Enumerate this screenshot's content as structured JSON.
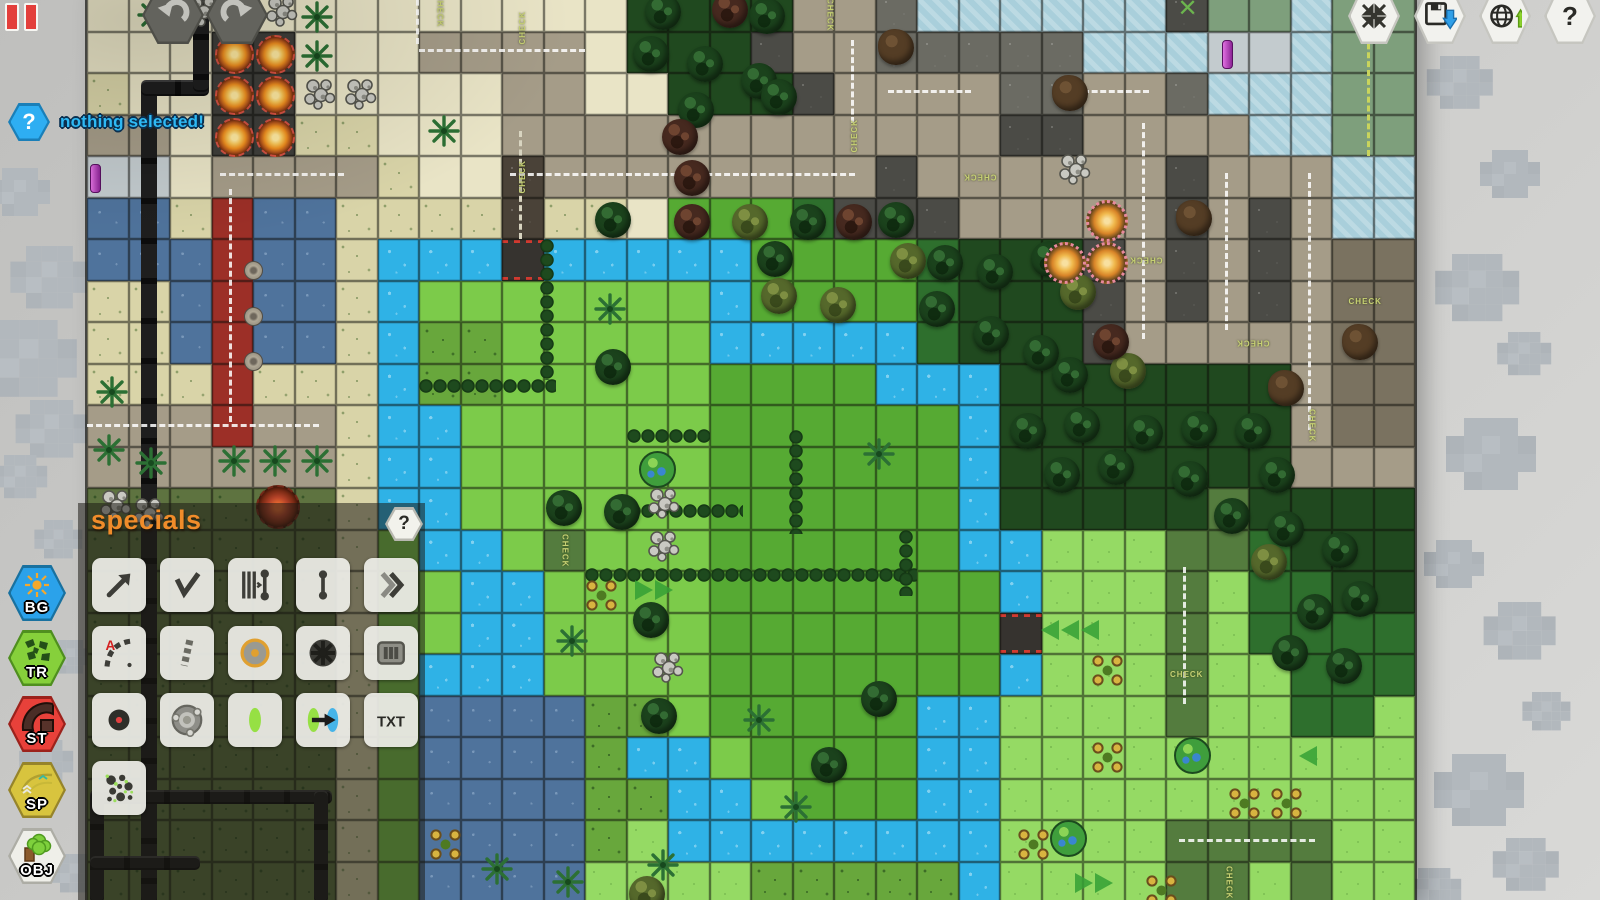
{
  "hud": {
    "pause_name": "pause-indicator",
    "undo_label": "undo",
    "redo_label": "redo",
    "status": {
      "glyph": "?",
      "text": "nothing selected!"
    },
    "topright": [
      {
        "name": "center-view",
        "icon": "arrows-in-icon"
      },
      {
        "name": "save-map",
        "icon": "floppy-save-icon"
      },
      {
        "name": "publish-map",
        "icon": "globe-upload-icon"
      },
      {
        "name": "help",
        "icon": "question-icon",
        "glyph": "?"
      }
    ]
  },
  "sidebar": [
    {
      "id": "bg",
      "label": "BG",
      "color": "#2ba2ea",
      "border": "#19719f",
      "icon": "sun-icon"
    },
    {
      "id": "tr",
      "label": "TR",
      "color": "#86d03b",
      "border": "#4f8f1f",
      "icon": "terrain-icon"
    },
    {
      "id": "st",
      "label": "ST",
      "color": "#e8413a",
      "border": "#9c221c",
      "icon": "street-icon"
    },
    {
      "id": "sp",
      "label": "SP",
      "color": "#d8c43e",
      "border": "#96842a",
      "icon": "special-icon"
    },
    {
      "id": "obj",
      "label": "OBJ",
      "color": "#efefe9",
      "border": "#adada5",
      "icon": "object-icon"
    }
  ],
  "panel": {
    "title": "specials",
    "help_glyph": "?",
    "txt_label": "TXT",
    "tools": [
      {
        "name": "ramp-arrow",
        "glyph": "arrow"
      },
      {
        "name": "checkpoint-check",
        "glyph": "check"
      },
      {
        "name": "start-gate",
        "glyph": "gate"
      },
      {
        "name": "connector-post",
        "glyph": "post"
      },
      {
        "name": "boost-chevrons",
        "glyph": "chevrons"
      },
      {
        "name": "path-a-curve",
        "glyph": "finish"
      },
      {
        "name": "barrier-stripe",
        "glyph": "stripe"
      },
      {
        "name": "landmine",
        "glyph": "mine"
      },
      {
        "name": "tire-wheel",
        "glyph": "wheel"
      },
      {
        "name": "grate",
        "glyph": "grate"
      },
      {
        "name": "spawn-dot",
        "glyph": "spawn"
      },
      {
        "name": "turret-mount",
        "glyph": "mount"
      },
      {
        "name": "portal-oval",
        "glyph": "portal"
      },
      {
        "name": "teleporter",
        "glyph": "teleport"
      },
      {
        "name": "text-label",
        "glyph": "txt"
      },
      {
        "name": "camo-splat",
        "glyph": "camo"
      }
    ]
  },
  "map": {
    "left": 87,
    "top": -10,
    "tile": 41.5,
    "cols": 32,
    "rows": 22,
    "check_label": "CHECK",
    "palette": {
      "s": "#e9e4c6",
      "S": "#d9d4a8",
      "q": "#5e7340",
      "r": "#a59c88",
      "R": "#9c2f27",
      "k": "#6b6b63",
      "A": "#4b4b46",
      "x": "#3e3e3a",
      "n": "#4a4238",
      "g": "#56aa33",
      "l": "#7ccb4a",
      "e": "#95da64",
      "d": "#2e6f2d",
      "D": "#20491f",
      "m": "#68a73c",
      "w": "#2fb2e6",
      "W": "#a9cfdb",
      "B": "#4f739c",
      "p": "#c3cbce",
      "o": "#547c3e",
      "b": "#7a7260",
      "v": "#7e9f7c",
      "c": "#36332f"
    },
    "tiles": [
      "sssssssssssssDDDDrrkWWWWWWAvvWvv",
      "sssxxsssrrrrsDDDArrkkkkkWWWppWvv",
      "SssxxsssssrrssDDDArrrrkkrrkWWWvv",
      "rrsxxSSsssrrrrrrrrrrrrAArrrrWWvv",
      "ppsrrrrSssnrrrrrrrrArrrrrrArrrWW",
      "BBSRBBSSSSnSSsgggdAAArrrrrArArWW",
      "BBBRBBSwwwcwwwwwggggdDDDArArArbb",
      "SSBRBBSwlllllllwggggdDDDArArArbb",
      "SSBRBBSwmmlllllwwwwwdDDDArrrrrbb",
      "SSSRSSSwmmlllllggggwwwDDDDDDDrbb",
      "rrrRrrSwwllllllggggggwDDDDDDDrbb",
      "rrrrrrSwwllllllggggggwDDDDDDDrrr",
      "qqqqqqSwwllllllggggggwDDDDDoDDDD",
      "qqqqqqSlwwlolllggggggwweeeoodDDD",
      "qqqqqqSllwwllllgggggggweeeoeddDD",
      "qqqqqqSllwwllllgggggggceeeoedddd",
      "qqqqqqSlwwwllllgggggggweeeoeeddd",
      "qqqqqqSlBBBBmmlgggggwweeeeoeedde",
      "qqqqqqSlBBBBmwwlggggwweeeeeeeeee",
      "qqqqqqSlBBBBmmwwlgggwweeeeeeeeee",
      "qqqqqqSlBBBBmewwwwwwwweeeeooooee",
      "qqqqqqSlBBBBeeeemmmmmweeeeooeoee"
    ],
    "trees": {
      "dark": [
        [
          13.4,
          0.05
        ],
        [
          15.9,
          0.15
        ],
        [
          13.1,
          1.05
        ],
        [
          14.4,
          1.3
        ],
        [
          15.7,
          1.7
        ],
        [
          14.2,
          2.4
        ],
        [
          16.2,
          2.1
        ],
        [
          12.2,
          5.05
        ],
        [
          16.9,
          5.1
        ],
        [
          19.0,
          5.05
        ],
        [
          16.1,
          6.0
        ],
        [
          20.2,
          6.1
        ],
        [
          21.4,
          6.3
        ],
        [
          22.7,
          6.0
        ],
        [
          20.0,
          7.2
        ],
        [
          21.3,
          7.8
        ],
        [
          22.5,
          8.25
        ],
        [
          23.2,
          8.8
        ],
        [
          22.2,
          10.15
        ],
        [
          23.5,
          10.0
        ],
        [
          25.0,
          10.2
        ],
        [
          26.3,
          10.1
        ],
        [
          27.6,
          10.15
        ],
        [
          23.0,
          11.2
        ],
        [
          24.3,
          11.0
        ],
        [
          26.1,
          11.3
        ],
        [
          28.2,
          11.2
        ],
        [
          27.1,
          12.2
        ],
        [
          28.4,
          12.5
        ],
        [
          29.7,
          13.0
        ],
        [
          29.1,
          14.5
        ],
        [
          30.2,
          14.2
        ],
        [
          28.5,
          15.5
        ],
        [
          29.8,
          15.8
        ],
        [
          12.2,
          8.6
        ],
        [
          11.0,
          12.0
        ],
        [
          12.4,
          12.1
        ],
        [
          13.1,
          14.7
        ],
        [
          13.3,
          17.0
        ],
        [
          17.4,
          18.2
        ],
        [
          18.6,
          16.6
        ]
      ],
      "olive": [
        [
          17.6,
          7.1
        ],
        [
          23.4,
          6.8
        ],
        [
          28.0,
          13.3
        ],
        [
          24.6,
          8.7
        ],
        [
          15.5,
          5.1
        ],
        [
          16.2,
          6.9
        ],
        [
          13.0,
          21.3
        ],
        [
          19.3,
          6.05
        ]
      ],
      "red": [
        [
          15.0,
          0.0
        ],
        [
          14.1,
          4.05
        ],
        [
          14.1,
          5.1
        ],
        [
          18.0,
          5.1
        ],
        [
          24.2,
          8.0
        ],
        [
          13.8,
          3.05
        ]
      ]
    },
    "dirt": [
      [
        19.0,
        0.9
      ],
      [
        23.2,
        2.0
      ],
      [
        26.2,
        5.0
      ],
      [
        30.2,
        8.0
      ],
      [
        28.4,
        9.1
      ]
    ],
    "palms": [
      [
        1.1,
        0.1
      ],
      [
        5.05,
        0.15
      ],
      [
        5.05,
        1.1
      ],
      [
        8.1,
        2.9
      ],
      [
        12.1,
        7.2
      ],
      [
        18.6,
        10.7
      ],
      [
        11.2,
        15.2
      ],
      [
        0.1,
        9.2
      ],
      [
        0.05,
        10.6
      ],
      [
        1.05,
        10.9
      ],
      [
        3.05,
        10.85
      ],
      [
        4.05,
        10.85
      ],
      [
        5.05,
        10.85
      ],
      [
        15.7,
        17.1
      ],
      [
        16.6,
        19.2
      ],
      [
        9.4,
        20.7
      ],
      [
        11.1,
        21.0
      ],
      [
        13.4,
        20.6
      ]
    ],
    "rocks": [
      [
        4.2,
        0.0
      ],
      [
        2.3,
        0.0
      ],
      [
        5.1,
        2.0
      ],
      [
        6.1,
        2.0
      ],
      [
        23.3,
        3.8
      ],
      [
        13.4,
        11.85
      ],
      [
        13.4,
        12.9
      ],
      [
        13.5,
        15.8
      ],
      [
        0.2,
        11.9
      ],
      [
        1.0,
        12.1
      ]
    ],
    "fire_orbs": [
      [
        3,
        1
      ],
      [
        4,
        1
      ],
      [
        3,
        2
      ],
      [
        4,
        2
      ],
      [
        3,
        3
      ],
      [
        4,
        3
      ]
    ],
    "fire_red": [
      [
        4.0,
        11.85
      ]
    ],
    "gear_orbs": [
      [
        24,
        5
      ],
      [
        23,
        6
      ],
      [
        24,
        6
      ]
    ],
    "earth_orbs": [
      [
        13.2,
        11.0
      ],
      [
        26.1,
        17.9
      ],
      [
        23.1,
        19.9
      ]
    ],
    "flowers": [
      [
        11.9,
        14.1
      ],
      [
        24.1,
        15.9
      ],
      [
        24.1,
        18.0
      ],
      [
        27.4,
        19.1
      ],
      [
        28.4,
        19.1
      ],
      [
        22.3,
        20.1
      ],
      [
        25.4,
        21.2
      ],
      [
        8.15,
        20.1
      ]
    ],
    "manholes": [
      [
        3.5,
        6.25
      ],
      [
        3.5,
        7.35
      ],
      [
        3.5,
        8.45
      ]
    ],
    "pickups": [
      [
        0.02,
        4.05
      ],
      [
        27.3,
        1.05
      ]
    ],
    "hazards": [
      [
        26,
        0
      ]
    ],
    "arrows": [
      {
        "dir": "left",
        "count": 3,
        "at": [
          22.9,
          15.1
        ]
      },
      {
        "dir": "left",
        "count": 1,
        "at": [
          29.1,
          18.15
        ]
      },
      {
        "dir": "right",
        "count": 2,
        "at": [
          23.7,
          21.2
        ]
      },
      {
        "dir": "right",
        "count": 2,
        "at": [
          13.1,
          14.15
        ]
      }
    ],
    "checks": [
      {
        "at": [
          8,
          0
        ],
        "o": "v"
      },
      {
        "at": [
          10,
          0.4
        ],
        "o": "v",
        "rev": true
      },
      {
        "at": [
          17.4,
          0.1
        ],
        "o": "v"
      },
      {
        "at": [
          18,
          3
        ],
        "o": "v",
        "rev": true
      },
      {
        "at": [
          10,
          4
        ],
        "o": "v",
        "rev": true
      },
      {
        "at": [
          21,
          4
        ],
        "o": "h",
        "rev": true
      },
      {
        "at": [
          25,
          6
        ],
        "o": "h",
        "rev": true
      },
      {
        "at": [
          27.6,
          8
        ],
        "o": "h",
        "rev": true
      },
      {
        "at": [
          30.3,
          7
        ],
        "o": "h"
      },
      {
        "at": [
          29,
          10
        ],
        "o": "v"
      },
      {
        "at": [
          11,
          13
        ],
        "o": "v"
      },
      {
        "at": [
          26,
          16
        ],
        "o": "h"
      },
      {
        "at": [
          27,
          21
        ],
        "o": "v"
      }
    ],
    "hedges": [
      {
        "o": "v",
        "at": [
          10.9,
          6.0
        ],
        "len": 3.4
      },
      {
        "o": "h",
        "at": [
          8.0,
          9.35
        ],
        "len": 3.3
      },
      {
        "o": "h",
        "at": [
          13.0,
          10.55
        ],
        "len": 2.0
      },
      {
        "o": "h",
        "at": [
          13.0,
          12.35
        ],
        "len": 2.8
      },
      {
        "o": "h",
        "at": [
          12.0,
          13.9
        ],
        "len": 8.0
      },
      {
        "o": "v",
        "at": [
          16.9,
          10.6
        ],
        "len": 2.5
      },
      {
        "o": "v",
        "at": [
          19.55,
          13.0
        ],
        "len": 1.6
      }
    ],
    "dashes": [
      {
        "o": "h",
        "at": [
          8.0,
          1.42
        ],
        "len": 4.0
      },
      {
        "o": "h",
        "at": [
          10.2,
          4.4
        ],
        "len": 8.3
      },
      {
        "o": "v",
        "at": [
          18.42,
          1.2
        ],
        "len": 2.0
      },
      {
        "o": "v",
        "at": [
          25.42,
          3.2
        ],
        "len": 5.2
      },
      {
        "o": "v",
        "at": [
          27.42,
          4.4
        ],
        "len": 3.8
      },
      {
        "o": "v",
        "at": [
          29.42,
          4.4
        ],
        "len": 6.2
      },
      {
        "o": "h",
        "at": [
          0.0,
          10.45
        ],
        "len": 5.6
      },
      {
        "o": "v",
        "at": [
          3.42,
          4.8
        ],
        "len": 5.6
      },
      {
        "o": "v",
        "at": [
          30.85,
          0.0
        ],
        "len": 4.0,
        "c": "#c9d45c"
      },
      {
        "o": "h",
        "at": [
          26.3,
          20.45
        ],
        "len": 3.3
      },
      {
        "o": "v",
        "at": [
          26.42,
          13.9
        ],
        "len": 3.3
      },
      {
        "o": "h",
        "at": [
          3.2,
          4.42
        ],
        "len": 3.0
      },
      {
        "o": "v",
        "at": [
          7.92,
          0.0
        ],
        "len": 1.3
      },
      {
        "o": "v",
        "at": [
          10.42,
          3.4
        ],
        "len": 2.6,
        "c": "#d8d4c0"
      },
      {
        "o": "h",
        "at": [
          19.3,
          2.42
        ],
        "len": 2.0
      },
      {
        "o": "h",
        "at": [
          23.6,
          2.42
        ],
        "len": 2.0
      }
    ],
    "pipes": [
      {
        "o": "v",
        "x": 141,
        "y": 84,
        "len": 820,
        "w": 16
      },
      {
        "o": "h",
        "x": 141,
        "y": 80,
        "len": 68,
        "w": 16
      },
      {
        "o": "v",
        "x": 193,
        "y": 0,
        "len": 92,
        "w": 16
      },
      {
        "o": "h",
        "x": 90,
        "y": 790,
        "len": 242,
        "w": 14
      },
      {
        "o": "v",
        "x": 314,
        "y": 790,
        "len": 113,
        "w": 14
      },
      {
        "o": "v",
        "x": 90,
        "y": 790,
        "len": 113,
        "w": 14
      },
      {
        "o": "h",
        "x": 90,
        "y": 856,
        "len": 110,
        "w": 14
      }
    ]
  },
  "clouds": [
    {
      "x": 2,
      "y": 168,
      "s": 1
    },
    {
      "x": 26,
      "y": 246,
      "s": 1.3
    },
    {
      "x": 0,
      "y": 320,
      "s": 1.6
    },
    {
      "x": 30,
      "y": 400,
      "s": 1.2
    },
    {
      "x": 4,
      "y": 455,
      "s": 0.9
    },
    {
      "x": 44,
      "y": 520,
      "s": 0.8
    },
    {
      "x": 58,
      "y": 640,
      "s": 0.7
    },
    {
      "x": 30,
      "y": 740,
      "s": 0.9
    },
    {
      "x": 60,
      "y": 854,
      "s": 0.8
    },
    {
      "x": 1440,
      "y": 56,
      "s": 1.1
    },
    {
      "x": 1492,
      "y": 150,
      "s": 1
    },
    {
      "x": 1452,
      "y": 254,
      "s": 1.4
    },
    {
      "x": 1508,
      "y": 332,
      "s": 0.9
    },
    {
      "x": 1464,
      "y": 418,
      "s": 1.5
    },
    {
      "x": 1436,
      "y": 540,
      "s": 1
    },
    {
      "x": 1498,
      "y": 602,
      "s": 1.2
    },
    {
      "x": 1532,
      "y": 692,
      "s": 0.8
    },
    {
      "x": 1452,
      "y": 754,
      "s": 1.5
    },
    {
      "x": 1506,
      "y": 838,
      "s": 1.1
    },
    {
      "x": 1418,
      "y": 868,
      "s": 0.9
    }
  ]
}
